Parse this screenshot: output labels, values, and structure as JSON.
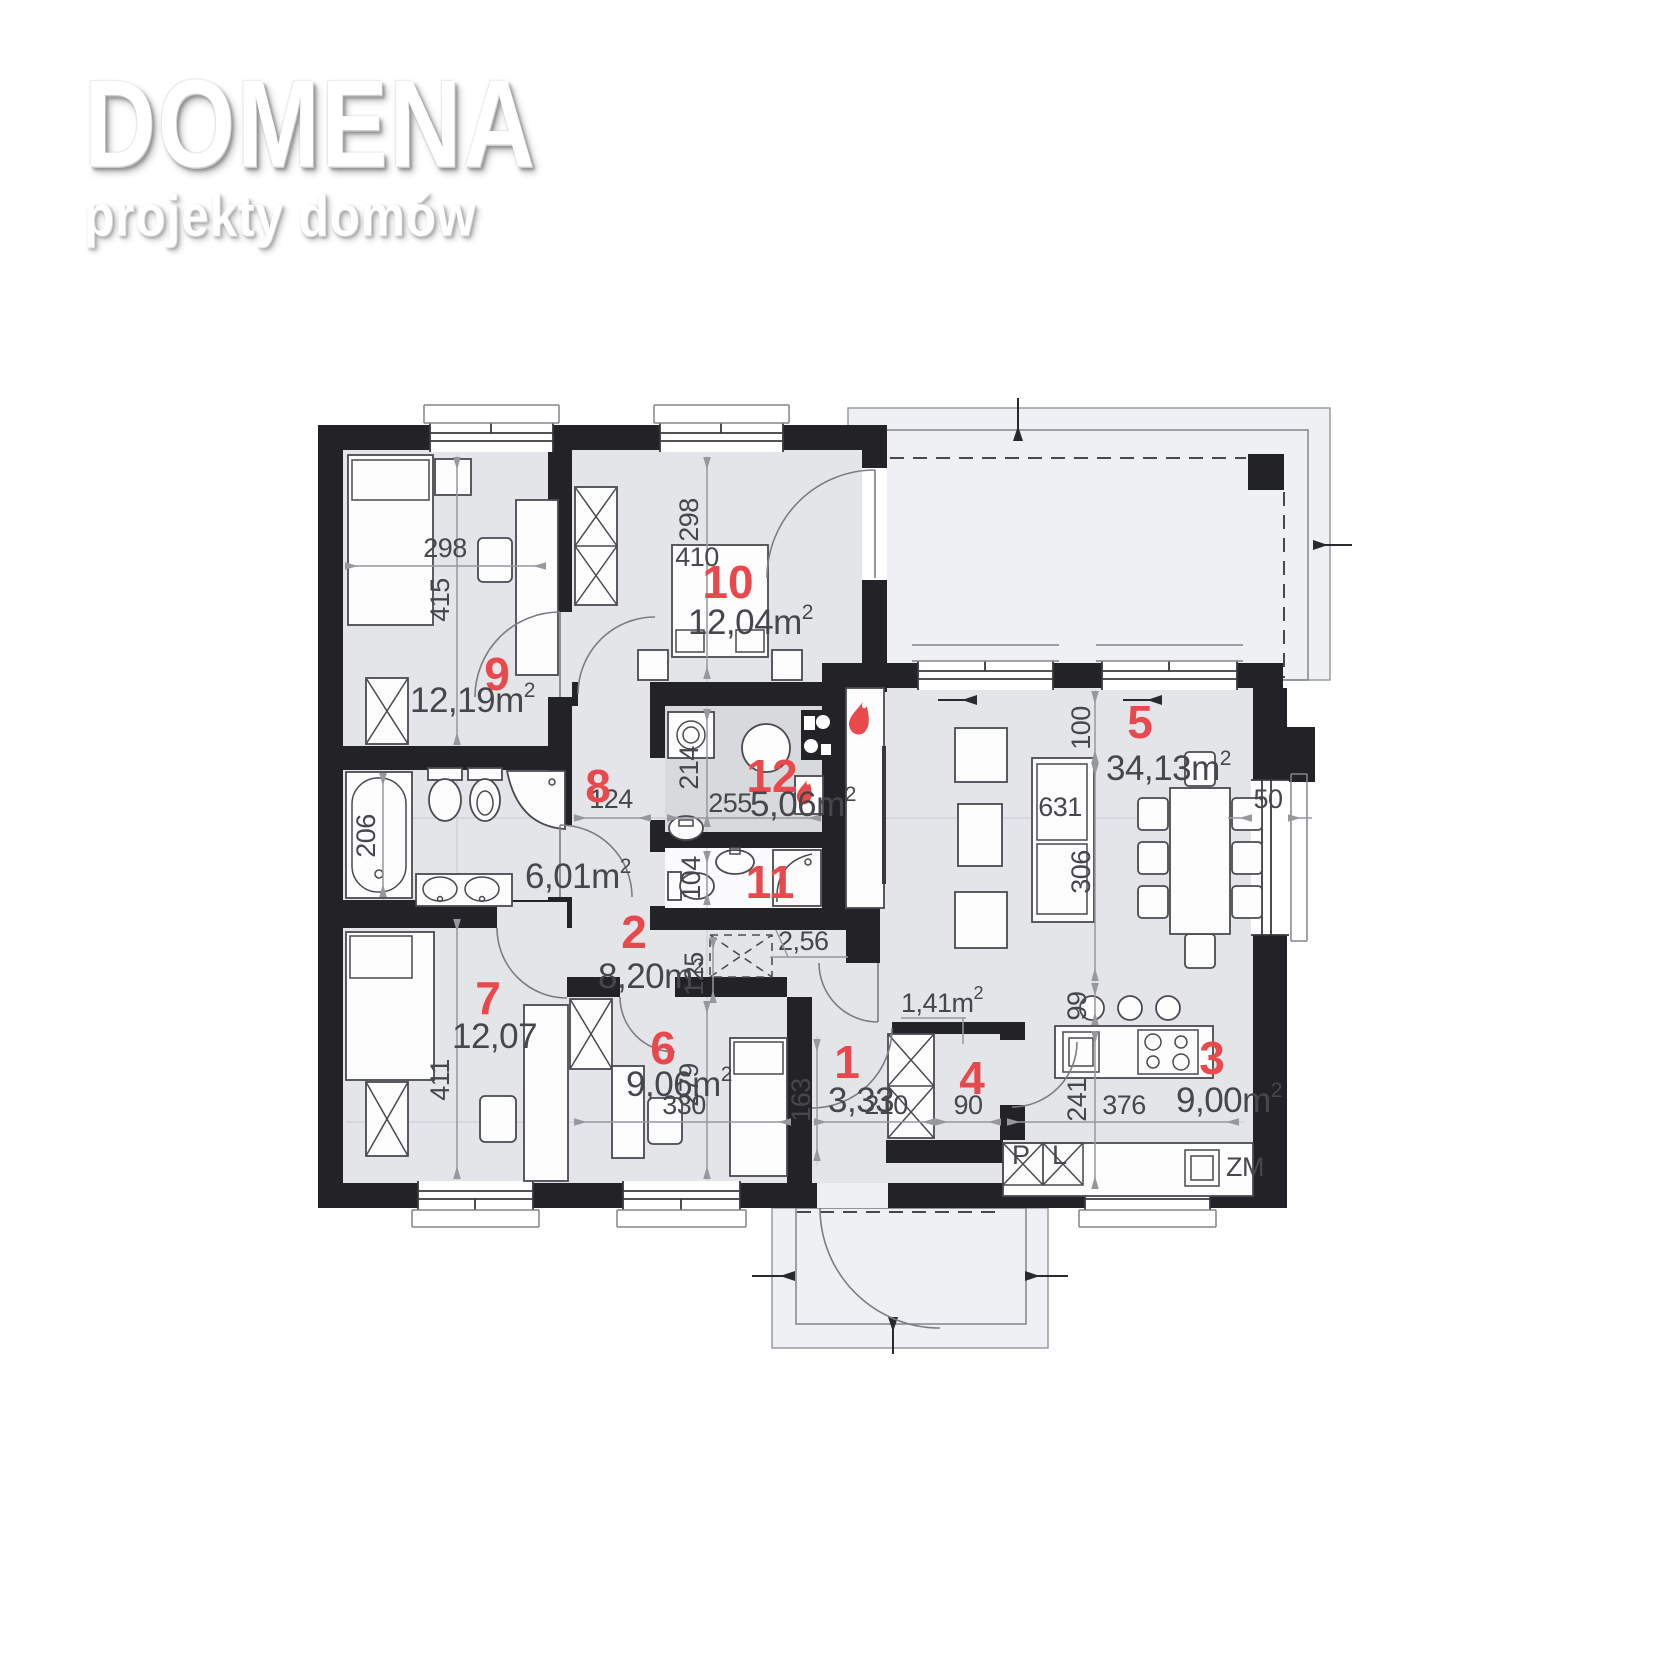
{
  "logo": {
    "title": "DOMENA",
    "subtitle": "projekty domów"
  },
  "rooms": [
    {
      "number": "1",
      "area": "3,33",
      "sup": ""
    },
    {
      "number": "2",
      "area": "8,20m",
      "sup": "2"
    },
    {
      "number": "3",
      "area": "9,00m",
      "sup": "2"
    },
    {
      "number": "4",
      "area": "1,41m",
      "sup": "2"
    },
    {
      "number": "5",
      "area": "34,13m",
      "sup": "2"
    },
    {
      "number": "6",
      "area": "9,06m",
      "sup": "2"
    },
    {
      "number": "7",
      "area": "12,07",
      "sup": ""
    },
    {
      "number": "8",
      "area": "6,01m",
      "sup": "2"
    },
    {
      "number": "9",
      "area": "12,19m",
      "sup": "2"
    },
    {
      "number": "10",
      "area": "12,04m",
      "sup": "2"
    },
    {
      "number": "11",
      "area": "2,56",
      "sup": ""
    },
    {
      "number": "12",
      "area": "5,06m",
      "sup": "2"
    }
  ],
  "dims": {
    "r9_w": "298",
    "r9_h": "415",
    "r10_w": "410",
    "r10_h": "298",
    "r8_h": "206",
    "hall_w": "124",
    "r12_h": "214",
    "r12_w": "255",
    "r11_h": "104",
    "r2_h": "125",
    "r7_h": "411",
    "r6_w": "330",
    "r6_h": "279",
    "r1_h": "163",
    "r1_w": "210",
    "r4_w": "90",
    "r3_w": "376",
    "r3_h": "241",
    "island_off": "99",
    "r5_top": "100",
    "r5_mid": "306",
    "sofa_len": "631",
    "win_off": "50"
  },
  "appliances": {
    "p": "P",
    "l": "L",
    "zm": "ZM"
  },
  "colors": {
    "wall": "#232227",
    "floor": "#e4e5e9",
    "floor_dark": "#d8d9dc",
    "terrace": "#eef0f3",
    "accent_red": "#e8494d",
    "dim_text": "#46474c"
  }
}
